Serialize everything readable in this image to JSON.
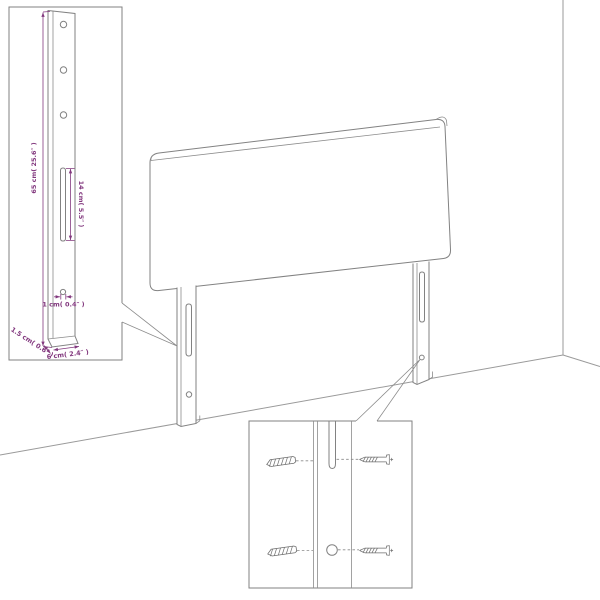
{
  "diagram": {
    "type": "product-assembly-dimension-diagram",
    "subject": "upholstered headboard with two slotted mounting legs shown in a room corner",
    "accent_color": "#82387e",
    "line_color": "#828282",
    "callout_post": {
      "description": "magnified detail of one mounting leg with holes, slot and foot",
      "dimensions": {
        "post_height": "65 cm( 25.6″ )",
        "slot_length": "14 cm( 5.5″ )",
        "hole_diameter": "1 cm( 0.4″ )",
        "post_depth": "1.5 cm( 0.6″ )",
        "post_width": "6 cm( 2.4″ )"
      }
    },
    "callout_screws": {
      "description": "magnified detail of leg slot and lower hole with hanger bolts and wood screws",
      "fasteners": [
        "hanger-bolt",
        "wood-screw",
        "hanger-bolt",
        "wood-screw"
      ]
    }
  }
}
